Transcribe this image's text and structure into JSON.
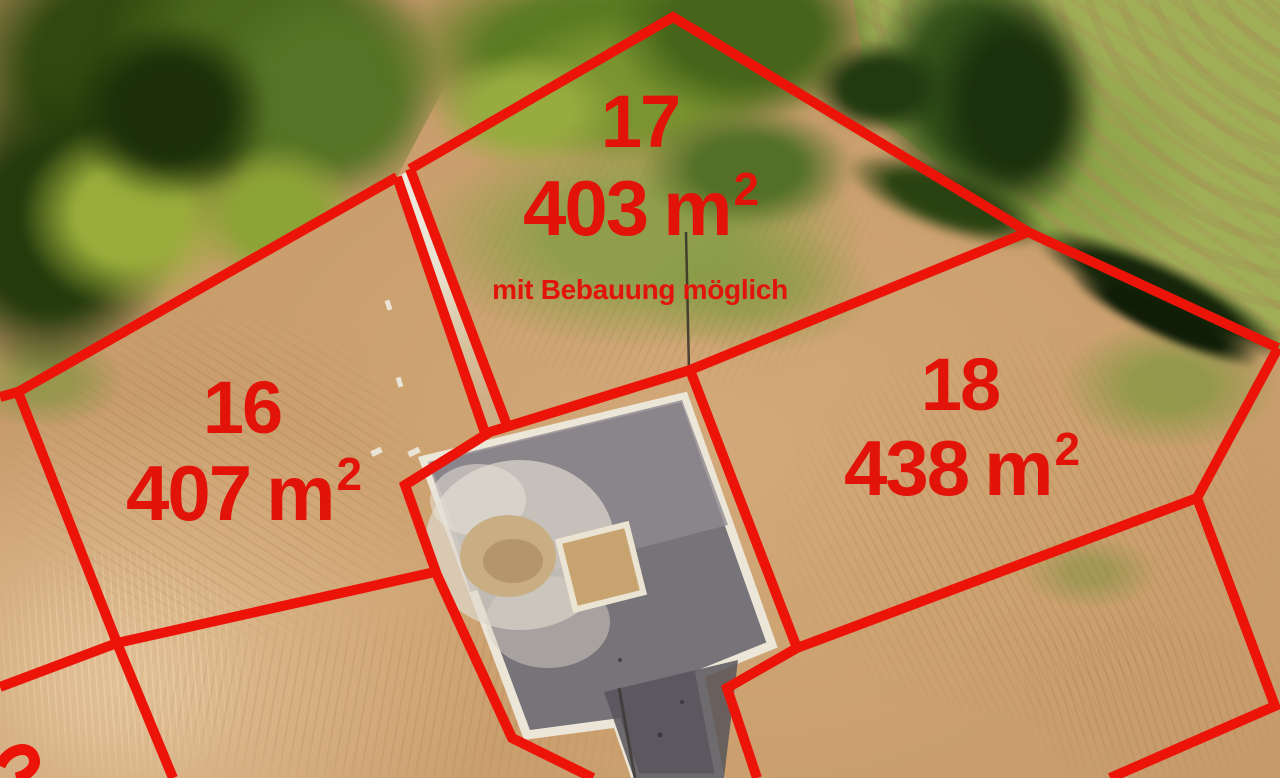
{
  "scene": "Luftbild Baugrundstücke mit roten Grundstücksgrenzen",
  "colors": {
    "boundary_red": "#ec1408",
    "label_red": "#e21308",
    "asphalt_gray": "#767379",
    "curb_white": "#ece6d8",
    "path_white": "#ece7da"
  },
  "plots": [
    {
      "id": "plot-16",
      "number": "16",
      "area_value": "407",
      "area_unit": "m",
      "area_superscript": "2"
    },
    {
      "id": "plot-17",
      "number": "17",
      "area_value": "403",
      "area_unit": "m",
      "area_superscript": "2",
      "note": "mit Bebauung möglich"
    },
    {
      "id": "plot-18",
      "number": "18",
      "area_value": "438",
      "area_unit": "m",
      "area_superscript": "2"
    }
  ],
  "boundaries": [
    {
      "name": "boundary-treeline-west",
      "points": [
        [
          0,
          397
        ],
        [
          18,
          392
        ],
        [
          397,
          177
        ]
      ]
    },
    {
      "name": "boundary-path-west",
      "points": [
        [
          397,
          177
        ],
        [
          485,
          433
        ]
      ]
    },
    {
      "name": "boundary-path-east",
      "points": [
        [
          410,
          169
        ],
        [
          508,
          428
        ]
      ]
    },
    {
      "name": "boundary-plot17-north",
      "points": [
        [
          410,
          169
        ],
        [
          673,
          17
        ],
        [
          1028,
          232
        ]
      ]
    },
    {
      "name": "boundary-plot18-north",
      "points": [
        [
          1028,
          232
        ],
        [
          1278,
          348
        ]
      ]
    },
    {
      "name": "boundary-plot18-east",
      "points": [
        [
          1278,
          348
        ],
        [
          1197,
          498
        ]
      ]
    },
    {
      "name": "boundary-plot18-south",
      "points": [
        [
          1197,
          498
        ],
        [
          797,
          648
        ]
      ]
    },
    {
      "name": "boundary-plot18-southeast",
      "points": [
        [
          1197,
          498
        ],
        [
          1275,
          706
        ],
        [
          1110,
          778
        ]
      ]
    },
    {
      "name": "boundary-plot17-18",
      "points": [
        [
          1028,
          232
        ],
        [
          690,
          370
        ]
      ]
    },
    {
      "name": "boundary-road-west",
      "points": [
        [
          690,
          370
        ],
        [
          490,
          432
        ],
        [
          405,
          485
        ],
        [
          437,
          575
        ],
        [
          512,
          738
        ],
        [
          593,
          778
        ]
      ]
    },
    {
      "name": "boundary-road-east",
      "points": [
        [
          690,
          370
        ],
        [
          797,
          648
        ]
      ]
    },
    {
      "name": "boundary-road-east-step",
      "points": [
        [
          797,
          648
        ],
        [
          727,
          688
        ],
        [
          757,
          778
        ]
      ]
    },
    {
      "name": "boundary-plot16-south",
      "points": [
        [
          117,
          643
        ],
        [
          435,
          572
        ]
      ]
    },
    {
      "name": "boundary-plot16-west",
      "points": [
        [
          18,
          392
        ],
        [
          117,
          643
        ],
        [
          173,
          778
        ]
      ]
    },
    {
      "name": "boundary-southwest",
      "points": [
        [
          117,
          643
        ],
        [
          0,
          687
        ]
      ]
    }
  ]
}
